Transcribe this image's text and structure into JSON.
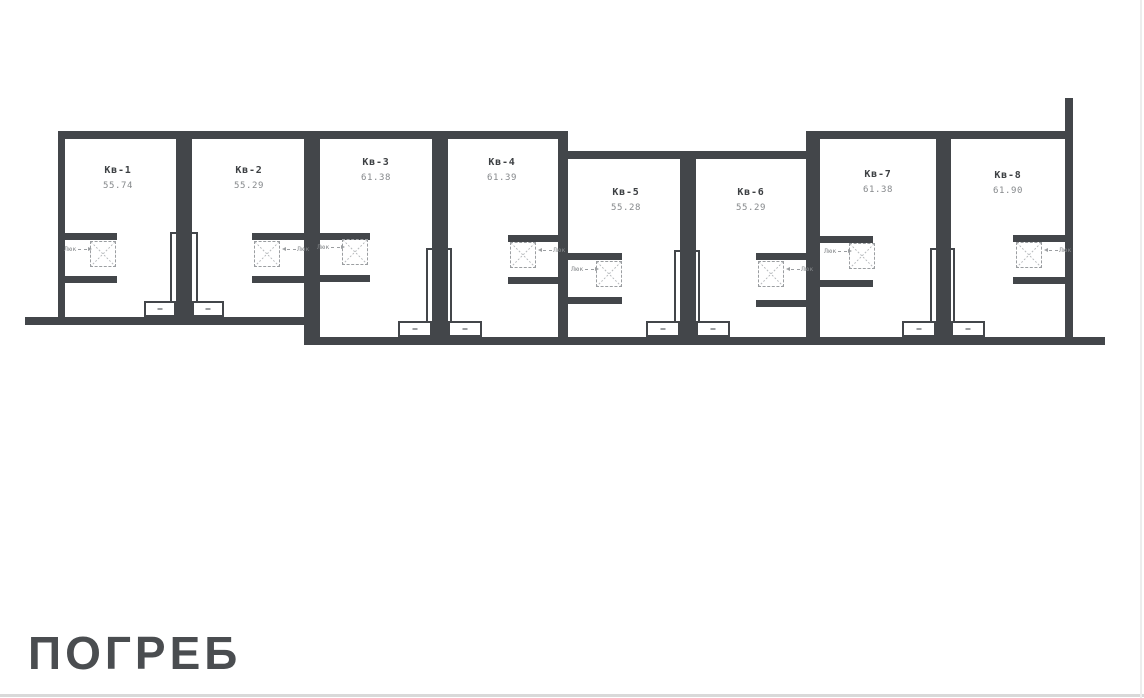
{
  "page": {
    "title": "ПОГРЕБ"
  },
  "plan": {
    "hatch_label": "Люк",
    "units": [
      {
        "name": "Кв-1",
        "area": "55.74"
      },
      {
        "name": "Кв-2",
        "area": "55.29"
      },
      {
        "name": "Кв-3",
        "area": "61.38"
      },
      {
        "name": "Кв-4",
        "area": "61.39"
      },
      {
        "name": "Кв-5",
        "area": "55.28"
      },
      {
        "name": "Кв-6",
        "area": "55.29"
      },
      {
        "name": "Кв-7",
        "area": "61.38"
      },
      {
        "name": "Кв-8",
        "area": "61.90"
      }
    ]
  },
  "colors": {
    "wall": "#43464a",
    "unit_name": "#3d4043",
    "unit_area": "#85888b",
    "hatch": "#9b9ea1",
    "title": "#4a4d50"
  }
}
